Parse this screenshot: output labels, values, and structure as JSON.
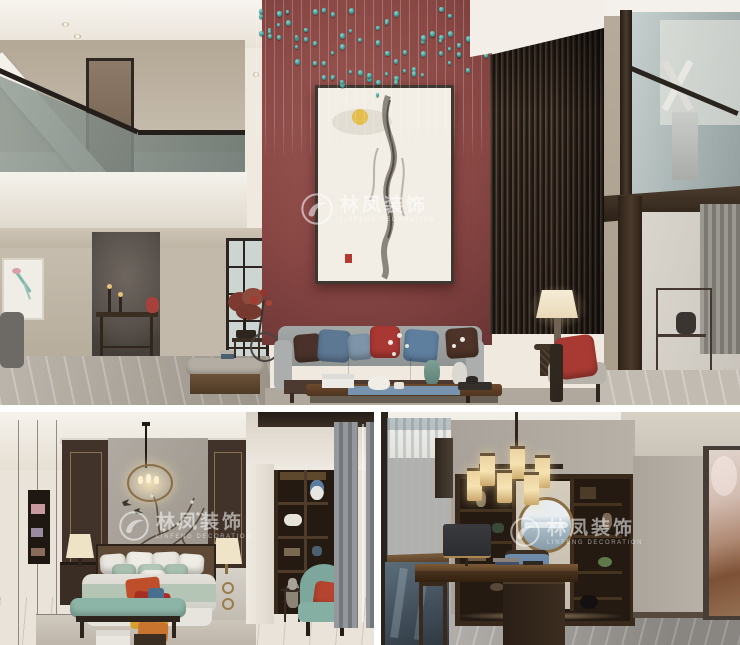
{
  "watermark": {
    "cn": "林凤装饰",
    "en": "LINFENG DECORATION",
    "logo": "phoenix-circle-icon"
  },
  "panels": {
    "living_room": {
      "label": "double-height living room",
      "subject": "red accent wall with ink painting, teal crystal drop chandelier, wood slat wall, gray sofa with blue and red pillows, mezzanine glass railings"
    },
    "bedroom": {
      "label": "bedroom",
      "subject": "blossom mural wall, lantern chandelier, sage bedding with orange patchwork throw, teal bench and armchair, dark wood wardrobe and shelving niche"
    },
    "study": {
      "label": "study",
      "subject": "dark bookshelf with round mountain artwork, cylinder shade chandelier, walnut desk with blue chair, sheer window over stairwell, rose abstract artwork"
    }
  },
  "colors": {
    "red-wall": "#8a4845",
    "red-wall-dark": "#582c2c",
    "teal-crystal": "#3f9e99",
    "slat-wood": "#3b2f26",
    "beige-wall": "#c5bcae",
    "white-trim": "#f2efe9",
    "marble-floor": "#b3aba0",
    "sofa-gray": "#9fa3a3",
    "pillow-red": "#a93732",
    "pillow-blue": "#5d7893",
    "pillow-brown": "#4a322b",
    "wood-frame": "#4c3930",
    "lamp-glow": "#f3e3bd",
    "bench-teal": "#8db5a7",
    "armchair-teal": "#7da79d",
    "throw-orange": "#bf4f2a",
    "throw-yellow": "#d79f2d",
    "sage-bedding": "#b4c5b6",
    "dark-wood": "#392c22",
    "mural-gray": "#a59f97",
    "desk-chair-blue": "#5c7c9e",
    "study-wall": "#b3ada5",
    "window-light": "#d9e7ec",
    "watermark": "#ffffff"
  }
}
